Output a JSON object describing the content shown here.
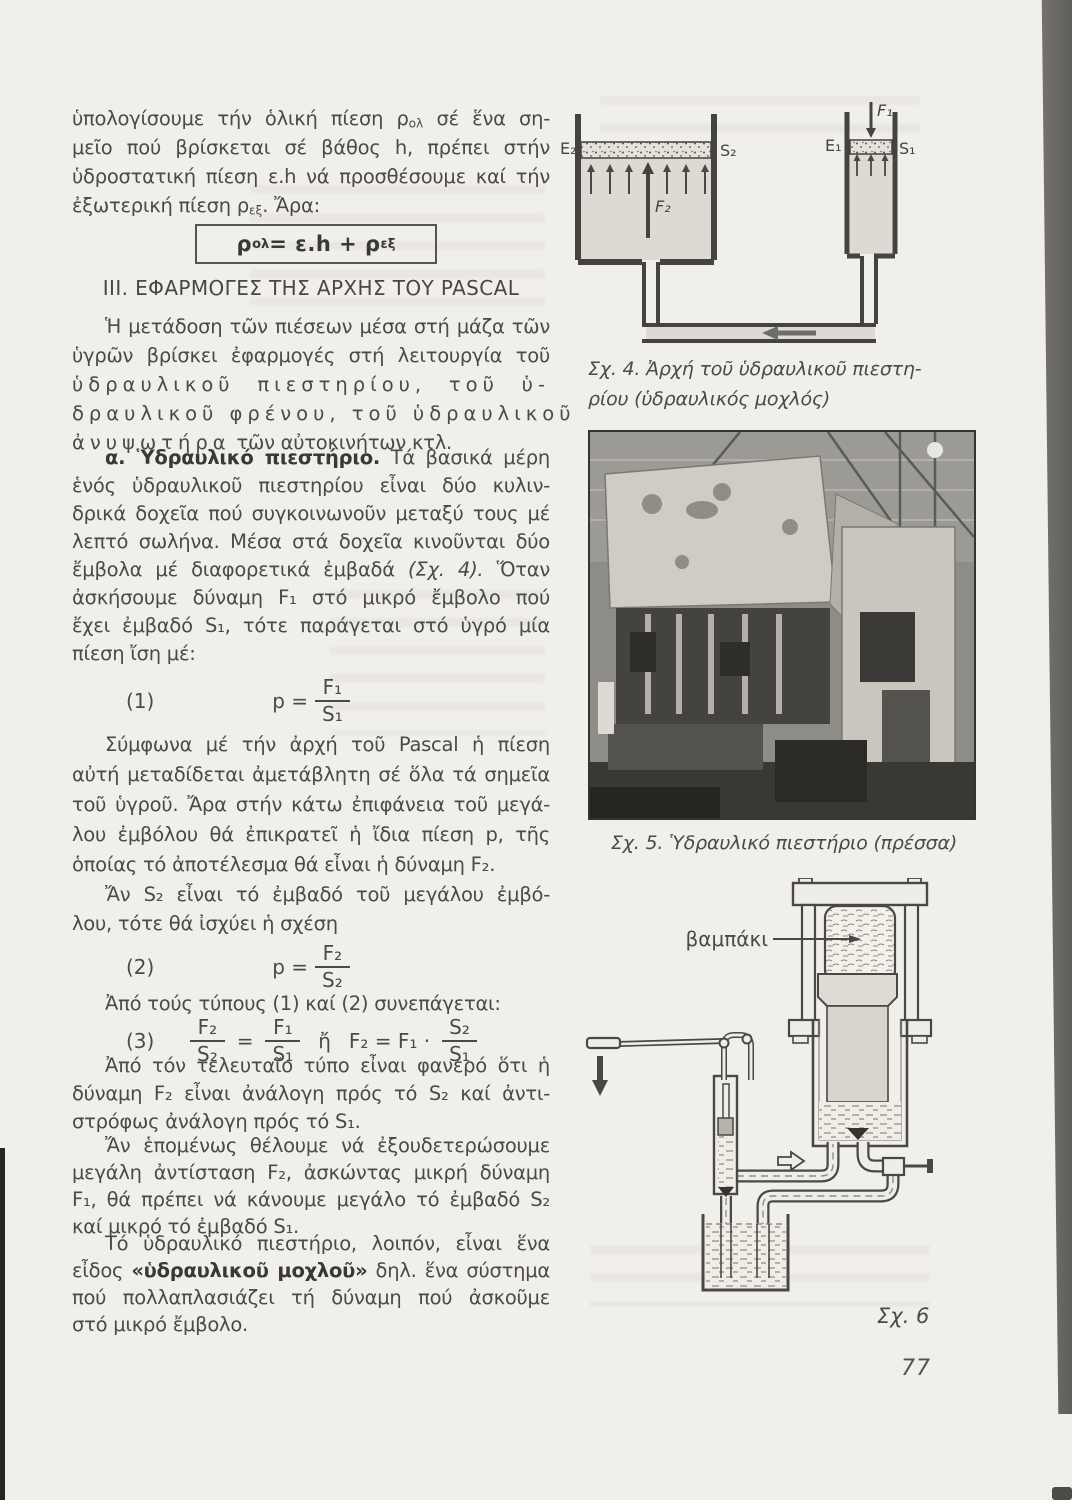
{
  "page_number": "77",
  "text": {
    "p1": {
      "l1a": "ὑπολογίσουμε τήν ὁλική πίεση ρ",
      "l1sub": "ολ",
      "l1b": " σέ ἕνα ση-",
      "l2": "μεῖο πού βρίσκεται σέ βάθος h, πρέπει στήν",
      "l3": "ὑδροστατική πίεση ε.h νά προσθέσουμε καί τήν",
      "l4a": "ἐξωτερική πίεση ρ",
      "l4sub": "εξ",
      "l4b": ". Ἄρα:"
    },
    "box": {
      "a": "ρ",
      "s1": "ολ",
      "b": " = ε.h + ρ",
      "s2": "εξ"
    },
    "heading": "III. ΕΦΑΡΜΟΓΕΣ ΤΗΣ ΑΡΧΗΣ ΤΟΥ PASCAL",
    "p2": {
      "l1": "Ἡ μετάδοση τῶν πιέσεων μέσα στή μάζα τῶν",
      "l2": "ὑγρῶν βρίσκει ἐφαρμογές στή λειτουργία τοῦ",
      "l3": "ὑδραυλικοῦ πιεστηρίου, τοῦ ὑ-",
      "l4": "δραυλικοῦ φρένου, τοῦ ὑδραυλικοῦ",
      "l5a": "ἀνυψωτήρα",
      "l5b": " τῶν αὐτοκινήτων κτλ."
    },
    "p3": {
      "l1a": "α. Ὑδραυλικό πιεστήριο.",
      "l1b": " Τά βασικά μέρη",
      "l2": "ἑνός ὑδραυλικοῦ πιεστηρίου εἶναι δύο κυλιν-",
      "l3": "δρικά δοχεῖα πού συγκοινωνοῦν μεταξύ τους μέ",
      "l4": "λεπτό σωλήνα. Μέσα στά δοχεῖα κινοῦνται δύο",
      "l5a": "ἔμβολα μέ διαφορετικά ἐμβαδά ",
      "l5i": "(Σχ. 4).",
      "l5b": " Ὅταν",
      "l6": "ἀσκήσουμε δύναμη F₁ στό μικρό ἔμβολο πού",
      "l7": "ἔχει ἐμβαδό S₁, τότε παράγεται στό ὑγρό μία",
      "l8": "πίεση ἴση μέ:"
    },
    "eq1": {
      "no": "(1)",
      "lhs": "p =",
      "num": "F₁",
      "den": "S₁"
    },
    "p4": {
      "l1": "Σύμφωνα μέ τήν ἀρχή τοῦ Pascal ἡ πίεση",
      "l2": "αὐτή μεταδίδεται ἀμετάβλητη σέ ὅλα τά σημεῖα",
      "l3": "τοῦ ὑγροῦ. Ἄρα στήν κάτω ἐπιφάνεια τοῦ μεγά-",
      "l4": "λου ἐμβόλου θά ἐπικρατεῖ ἡ ἴδια πίεση p, τῆς",
      "l5": "ὁποίας τό ἀποτέλεσμα θά εἶναι ἡ δύναμη F₂."
    },
    "p5": {
      "l1": "Ἄν S₂ εἶναι τό ἐμβαδό τοῦ μεγάλου ἐμβό-",
      "l2": "λου, τότε θά ἰσχύει ἡ σχέση"
    },
    "eq2": {
      "no": "(2)",
      "lhs": "p =",
      "num": "F₂",
      "den": "S₂"
    },
    "p6": {
      "l1": "Ἀπό τούς τύπους (1) καί (2) συνεπάγεται:"
    },
    "eq3": {
      "no": "(3)",
      "f1num": "F₂",
      "f1den": "S₂",
      "rel": "=",
      "f2num": "F₁",
      "f2den": "S₁",
      "or": "ἤ",
      "mid": "F₂ = F₁ ·",
      "f3num": "S₂",
      "f3den": "S₁"
    },
    "p7": {
      "l1": "Ἀπό τόν τελευταῖο τύπο εἶναι φανερό ὅτι ἡ",
      "l2": "δύναμη F₂ εἶναι ἀνάλογη πρός τό S₂ καί ἀντι-",
      "l3": "στρόφως ἀνάλογη πρός τό S₁."
    },
    "p8": {
      "l1": "Ἄν ἑπομένως θέλουμε νά ἐξουδετερώσουμε",
      "l2": "μεγάλη ἀντίσταση F₂, ἀσκώντας μικρή δύναμη",
      "l3": "F₁, θά πρέπει νά κάνουμε μεγάλο τό ἐμβαδό S₂",
      "l4": "καί μικρό τό ἐμβαδό S₁."
    },
    "p9": {
      "l1": "Τό ὑδραυλικό πιεστήριο, λοιπόν, εἶναι ἕνα",
      "l2a": "εἶδος ",
      "l2b": "«ὑδραυλικοῦ μοχλοῦ»",
      "l2c": " δηλ. ἕνα σύστημα",
      "l3": "πού πολλαπλασιάζει τή δύναμη πού ἀσκοῦμε",
      "l4": "στό μικρό ἔμβολο."
    }
  },
  "fig4": {
    "caption_l1": "Σχ. 4. Ἀρχή τοῦ ὑδραυλικοῦ πιεστη-",
    "caption_l2": "ρίου (ὑδραυλικός μοχλός)",
    "labels": {
      "E2": "E₂",
      "S2": "S₂",
      "E1": "E₁",
      "S1": "S₁",
      "F1": "F₁",
      "F2": "F₂"
    }
  },
  "fig5": {
    "caption": "Σχ. 5. Ὑδραυλικό πιεστήριο (πρέσσα)"
  },
  "fig6": {
    "label": "Σχ. 6",
    "cotton": "βαμπάκι"
  }
}
